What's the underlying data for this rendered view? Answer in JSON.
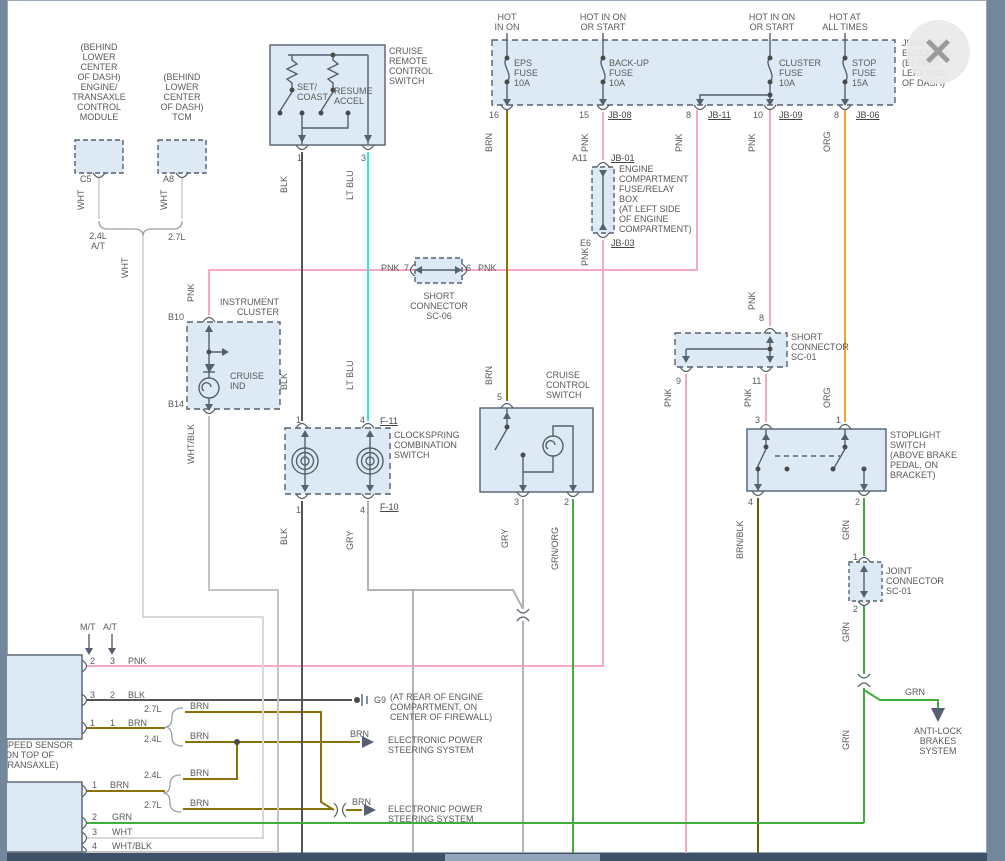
{
  "colors": {
    "pnk": "#f5a9c5",
    "brn": "#8a7208",
    "brnblk": "#6f5d05",
    "blk": "#555555",
    "wht": "#d8d8d8",
    "whtblk": "#c4c4c4",
    "gry": "#b3b3b3",
    "ltblu": "#35e3e8",
    "org": "#f0a02c",
    "grn": "#3fae3a",
    "box_fill": "#ddeaf6",
    "line": "#555555",
    "frame": "#72869c",
    "bottom_bar": "#3f5166"
  },
  "window": {
    "close_label": "✕"
  },
  "labels": {
    "module1": "(BEHIND\nLOWER\nCENTER\nOF DASH)\nENGINE/\nTRANSAXLE\nCONTROL\nMODULE",
    "tcm": "(BEHIND\nLOWER\nCENTER\nOF DASH)\nTCM",
    "c5": "C5",
    "a8": "A8",
    "eng24at": "2.4L\nA/T",
    "l27": "2.7L",
    "l24": "2.4L",
    "set_coast": "SET/\nCOAST",
    "resume": "RESUME\nACCEL",
    "cruise_remote": "CRUISE\nREMOTE\nCONTROL\nSWITCH",
    "hot_in_on": "HOT\nIN ON",
    "hot_start": "HOT IN ON\nOR START",
    "hot_all": "HOT AT\nALL TIMES",
    "eps_fuse": "EPS\nFUSE\n10A",
    "backup_fuse": "BACK-UP\nFUSE\n10A",
    "cluster_fuse": "CLUSTER\nFUSE\n10A",
    "stop_fuse": "STOP\nFUSE\n15A",
    "junction": "JUNCTION\nBLOCK (JB)\n(BEHIND\nLEFT SIDE\nOF DASH)",
    "jb08": "JB-08",
    "jb11": "JB-11",
    "jb09": "JB-09",
    "jb06": "JB-06",
    "jb01": "JB-01",
    "jb03": "JB-03",
    "f11": "F-11",
    "f10": "F-10",
    "a11": "A11",
    "e6": "E6",
    "ecfb": "ENGINE\nCOMPARTMENT\nFUSE/RELAY\nBOX\n(AT LEFT SIDE\nOF ENGINE\nCOMPARTMENT)",
    "short_sc06": "SHORT\nCONNECTOR\nSC-06",
    "short_sc01": "SHORT\nCONNECTOR\nSC-01",
    "joint_sc01": "JOINT\nCONNECTOR\nSC-01",
    "instr": "INSTRUMENT\nCLUSTER",
    "b10": "B10",
    "b14": "B14",
    "cruise_ind": "CRUISE\nIND",
    "clockspring": "CLOCKSPRING\nCOMBINATION\nSWITCH",
    "ccs": "CRUISE\nCONTROL\nSWITCH",
    "stoplight": "STOPLIGHT\nSWITCH\n(ABOVE BRAKE\nPEDAL, ON\nBRACKET)",
    "abs": "ANTI-LOCK\nBRAKES\nSYSTEM",
    "mt": "M/T",
    "at": "A/T",
    "speed_sensor": "SPEED SENSOR\n(ON TOP OF\nTRANSAXLE)",
    "g9": "G9",
    "g9_loc": "(AT REAR OF ENGINE\nCOMPARTMENT, ON\nCENTER OF FIREWALL)",
    "eps_sys": "ELECTRONIC POWER\nSTEERING SYSTEM",
    "pnk": "PNK",
    "brn": "BRN",
    "blk": "BLK",
    "wht": "WHT",
    "gry": "GRY",
    "org": "ORG",
    "grn": "GRN",
    "ltblu": "LT BLU",
    "whtblk": "WHT/BLK",
    "brnblk": "BRN/BLK",
    "grnorg": "GRN/ORG",
    "n1": "1",
    "n2": "2",
    "n3": "3",
    "n4": "4",
    "n5": "5",
    "n6": "6",
    "n7": "7",
    "n8": "8",
    "n9": "9",
    "n10": "10",
    "n11": "11",
    "n15": "15",
    "n16": "16"
  }
}
